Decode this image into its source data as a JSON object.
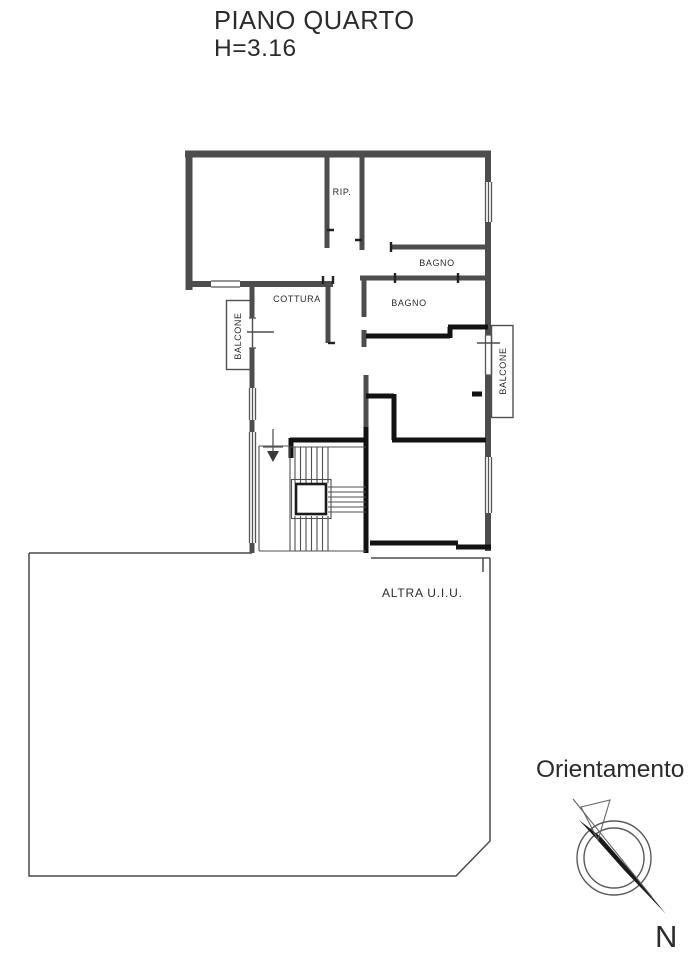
{
  "title": {
    "floor": "PIANO QUARTO",
    "height": "H=3.16"
  },
  "rooms": {
    "rip": "RIP.",
    "bagno_upper": "BAGNO",
    "bagno_lower": "BAGNO",
    "cottura": "COTTURA",
    "balcone_left": "BALCONE",
    "balcone_right": "BALCONE",
    "altra_uiu": "ALTRA U.I.U."
  },
  "orientation": {
    "heading": "Orientamento",
    "north": "N"
  },
  "colors": {
    "wall": "#4d4d4d",
    "wall_dark": "#121212",
    "ink": "#2b2b2b",
    "paper": "#ffffff"
  }
}
